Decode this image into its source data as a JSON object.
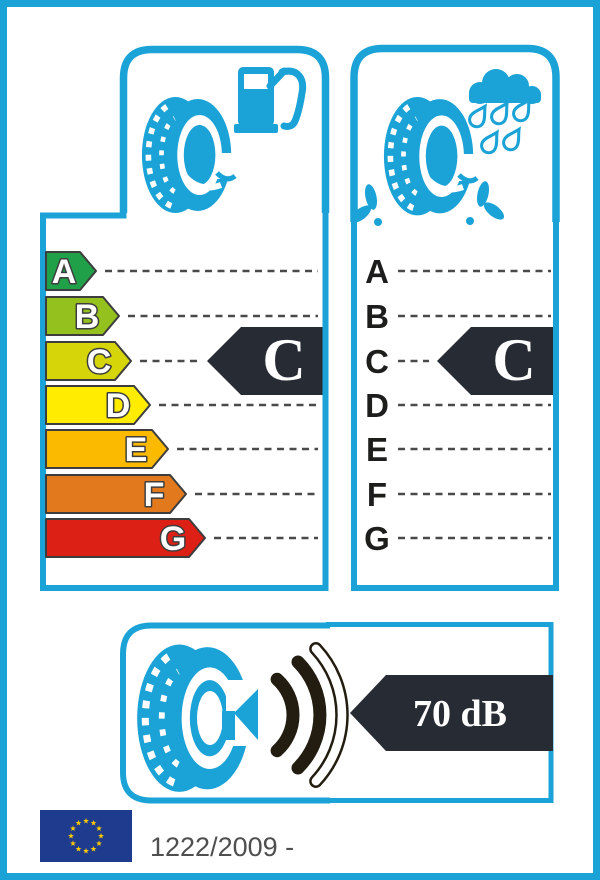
{
  "colors": {
    "accent": "#1BA2D6",
    "arrow_dark": "#272B33",
    "wave_dark": "#221D10",
    "dash": "#4A4A4A",
    "outline": "#3D3D3D",
    "flag_blue": "#1F3B8D",
    "star_yellow": "#FFCC00",
    "regulation_text": "#4F4F4F"
  },
  "fuel_panel": {
    "grades": [
      {
        "letter": "A",
        "color": "#21A04A"
      },
      {
        "letter": "B",
        "color": "#95C11F"
      },
      {
        "letter": "C",
        "color": "#D5D509"
      },
      {
        "letter": "D",
        "color": "#FFEC00"
      },
      {
        "letter": "E",
        "color": "#FBBA00"
      },
      {
        "letter": "F",
        "color": "#E2791D"
      },
      {
        "letter": "G",
        "color": "#DC2015"
      }
    ],
    "rating": "C"
  },
  "wet_grip_panel": {
    "grades": [
      "A",
      "B",
      "C",
      "D",
      "E",
      "F",
      "G"
    ],
    "rating": "C"
  },
  "noise_panel": {
    "value": "70 dB",
    "filled_waves": 2,
    "outlined_waves": 1
  },
  "footer": {
    "regulation": "1222/2009 -",
    "eu_flag_stars": 12
  }
}
